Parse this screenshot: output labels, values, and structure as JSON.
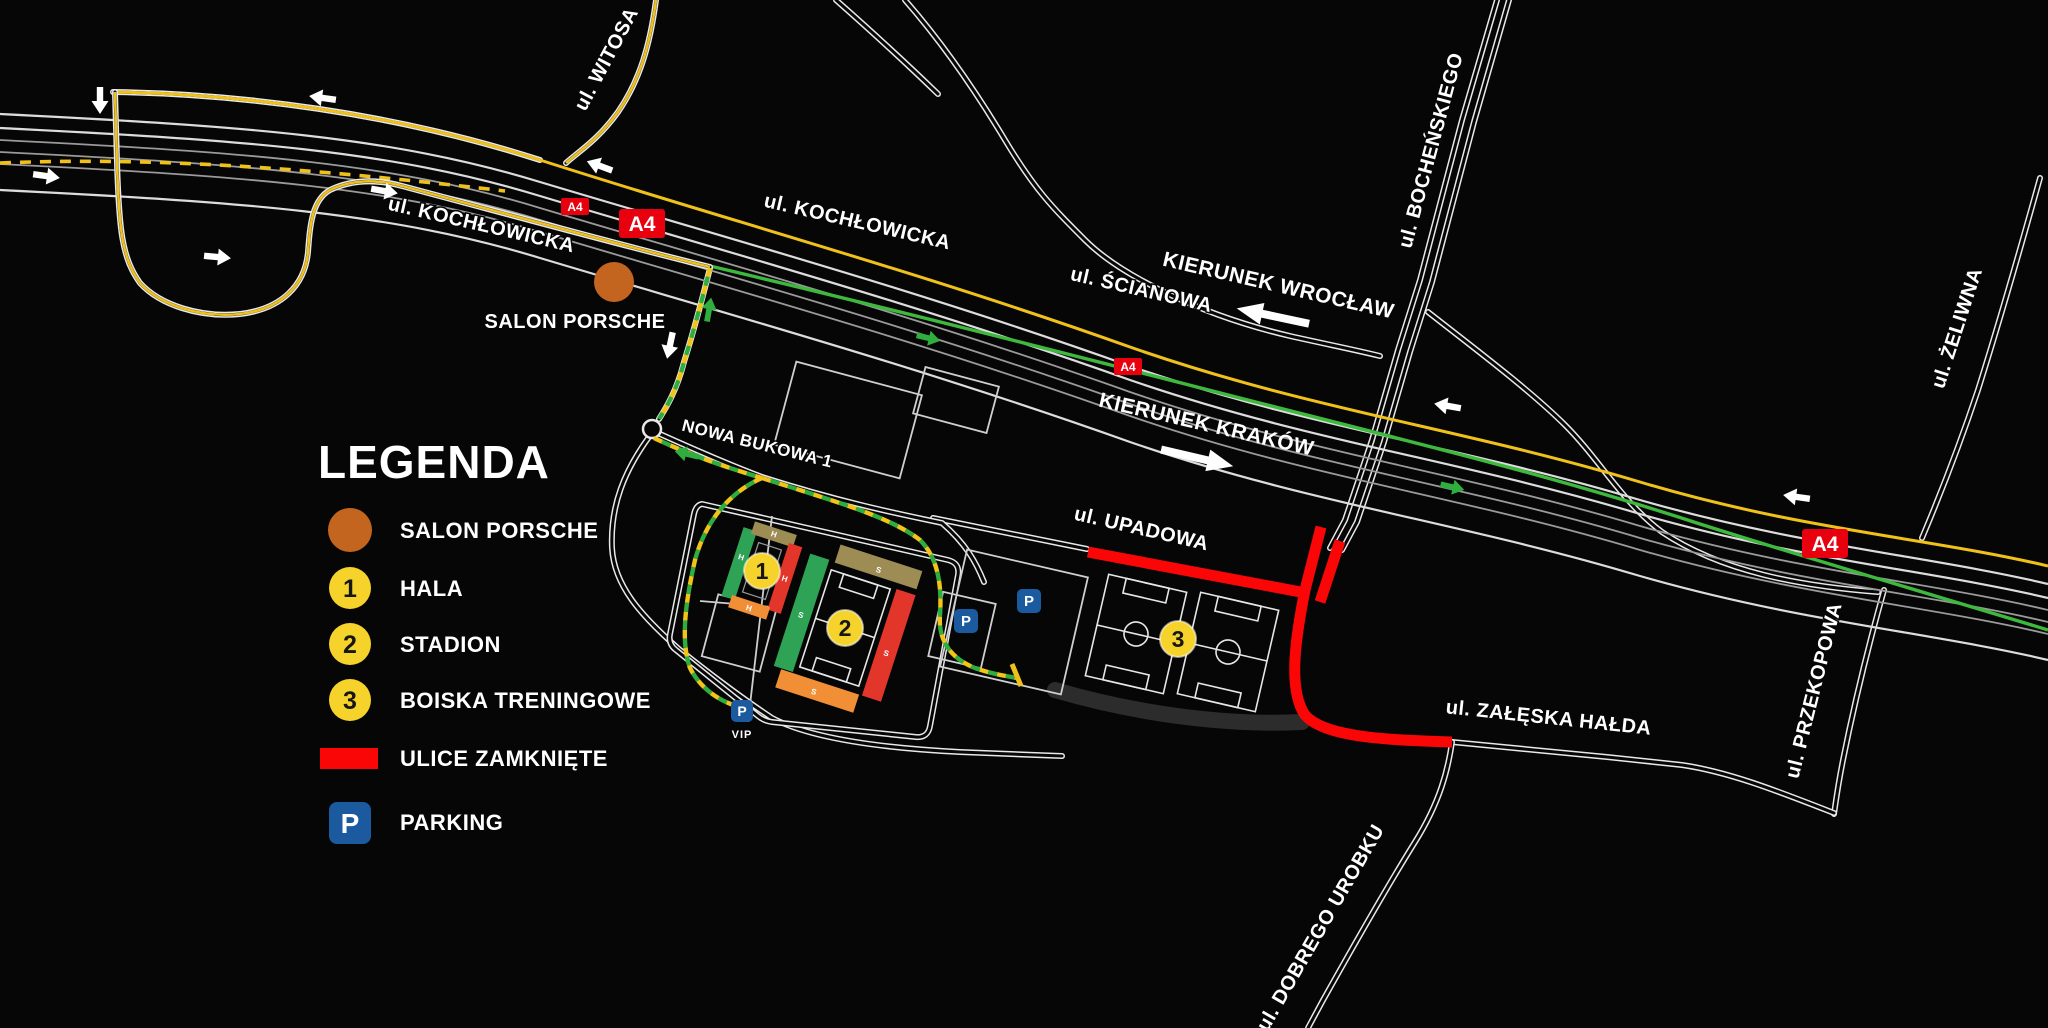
{
  "legend": {
    "title": "LEGENDA",
    "items": [
      {
        "id": "salon",
        "label": "SALON PORSCHE"
      },
      {
        "id": "hala",
        "number": "1",
        "label": "HALA"
      },
      {
        "id": "stadion",
        "number": "2",
        "label": "STADION"
      },
      {
        "id": "boiska",
        "number": "3",
        "label": "BOISKA TRENINGOWE"
      },
      {
        "id": "closed",
        "label": "ULICE ZAMKNIĘTE"
      },
      {
        "id": "parking",
        "label": "PARKING"
      }
    ]
  },
  "streets": {
    "witosa": "ul. WITOSA",
    "kochlowicka_west": "ul. KOCHŁOWICKA",
    "kochlowicka_east": "ul. KOCHŁOWICKA",
    "scianowa": "ul. ŚCIANOWA",
    "bochenskiego": "ul. BOCHEŃSKIEGO",
    "zeliwna": "ul. ŻELIWNA",
    "przekopowa": "ul. PRZEKOPOWA",
    "upadowa": "ul. UPADOWA",
    "zaleska_halda": "ul. ZAŁĘSKA HAŁDA",
    "dobrego_urobku": "ul. DOBREGO UROBKU",
    "nowa_bukowa": "NOWA BUKOWA 1"
  },
  "directions": {
    "wroclaw": "KIERUNEK WROCŁAW",
    "krakow": "KIERUNEK KRAKÓW"
  },
  "badges": {
    "a4": "A4",
    "parking_letter": "P",
    "vip": "VIP"
  },
  "markers": {
    "hala": "1",
    "stadion": "2",
    "boiska": "3"
  },
  "poi": {
    "salon_porsche": "SALON PORSCHE"
  },
  "sector_letters": {
    "hala": "H",
    "stadion": "S"
  },
  "colors": {
    "background": "#060606",
    "highway_yellow": "#efc11a",
    "route_green": "#3db93d",
    "closed_red": "#fb0606",
    "parking_blue": "#1b5a9e",
    "salon_orange": "#c4651f",
    "marker_yellow": "#f6d32b",
    "sector_green": "#2fa355",
    "sector_tan": "#9e8c55",
    "sector_red": "#e3362b",
    "sector_orange": "#f08f35"
  }
}
